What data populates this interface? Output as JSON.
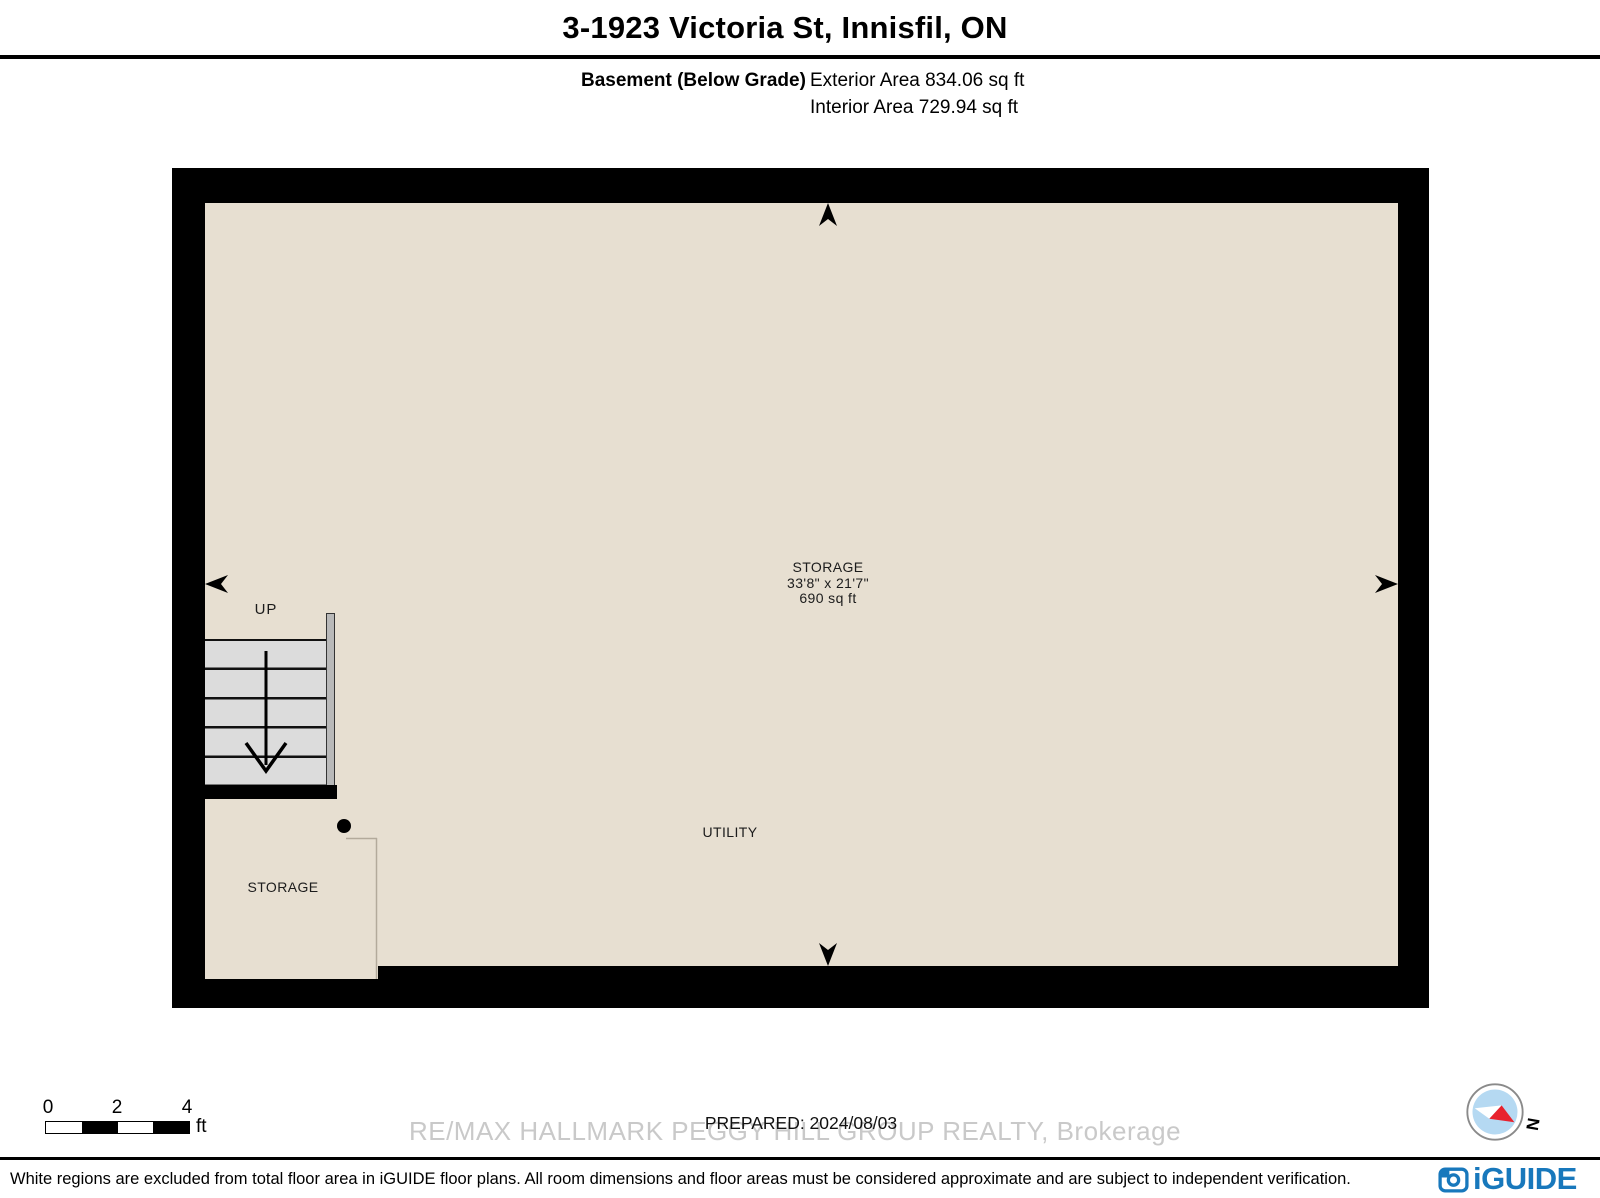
{
  "header": {
    "title": "3-1923 Victoria St, Innisfil, ON",
    "floor_label": "Basement (Below Grade)",
    "exterior_area": "Exterior Area 834.06 sq ft",
    "interior_area": "Interior Area 729.94 sq ft"
  },
  "plan": {
    "rooms": {
      "storage_main": {
        "name": "STORAGE",
        "dims": "33'8\" x 21'7\"",
        "area": "690 sq ft"
      },
      "utility": {
        "name": "UTILITY"
      },
      "storage_lower": {
        "name": "STORAGE"
      }
    },
    "stairs": {
      "direction_label": "UP"
    },
    "colors": {
      "wall": "#000000",
      "floor": "#e7dfd1",
      "stair_tread": "#dcdcdc",
      "stair_rail": "#b9b9b9"
    }
  },
  "scale_bar": {
    "tick_0": "0",
    "tick_1": "2",
    "tick_2": "4",
    "unit": "ft"
  },
  "notes": {
    "prepared": "PREPARED: 2024/08/03",
    "watermark": "RE/MAX HALLMARK PEGGY HILL GROUP REALTY, Brokerage"
  },
  "compass": {
    "north_label": "N",
    "needle_red": "#e8222d",
    "dial_blue": "#b5d9f2"
  },
  "footer": {
    "disclaimer": "White regions are excluded from total floor area in iGUIDE floor plans. All room dimensions and floor areas must be considered approximate and are subject to independent verification.",
    "brand": "iGUIDE",
    "brand_color": "#1878bc"
  }
}
